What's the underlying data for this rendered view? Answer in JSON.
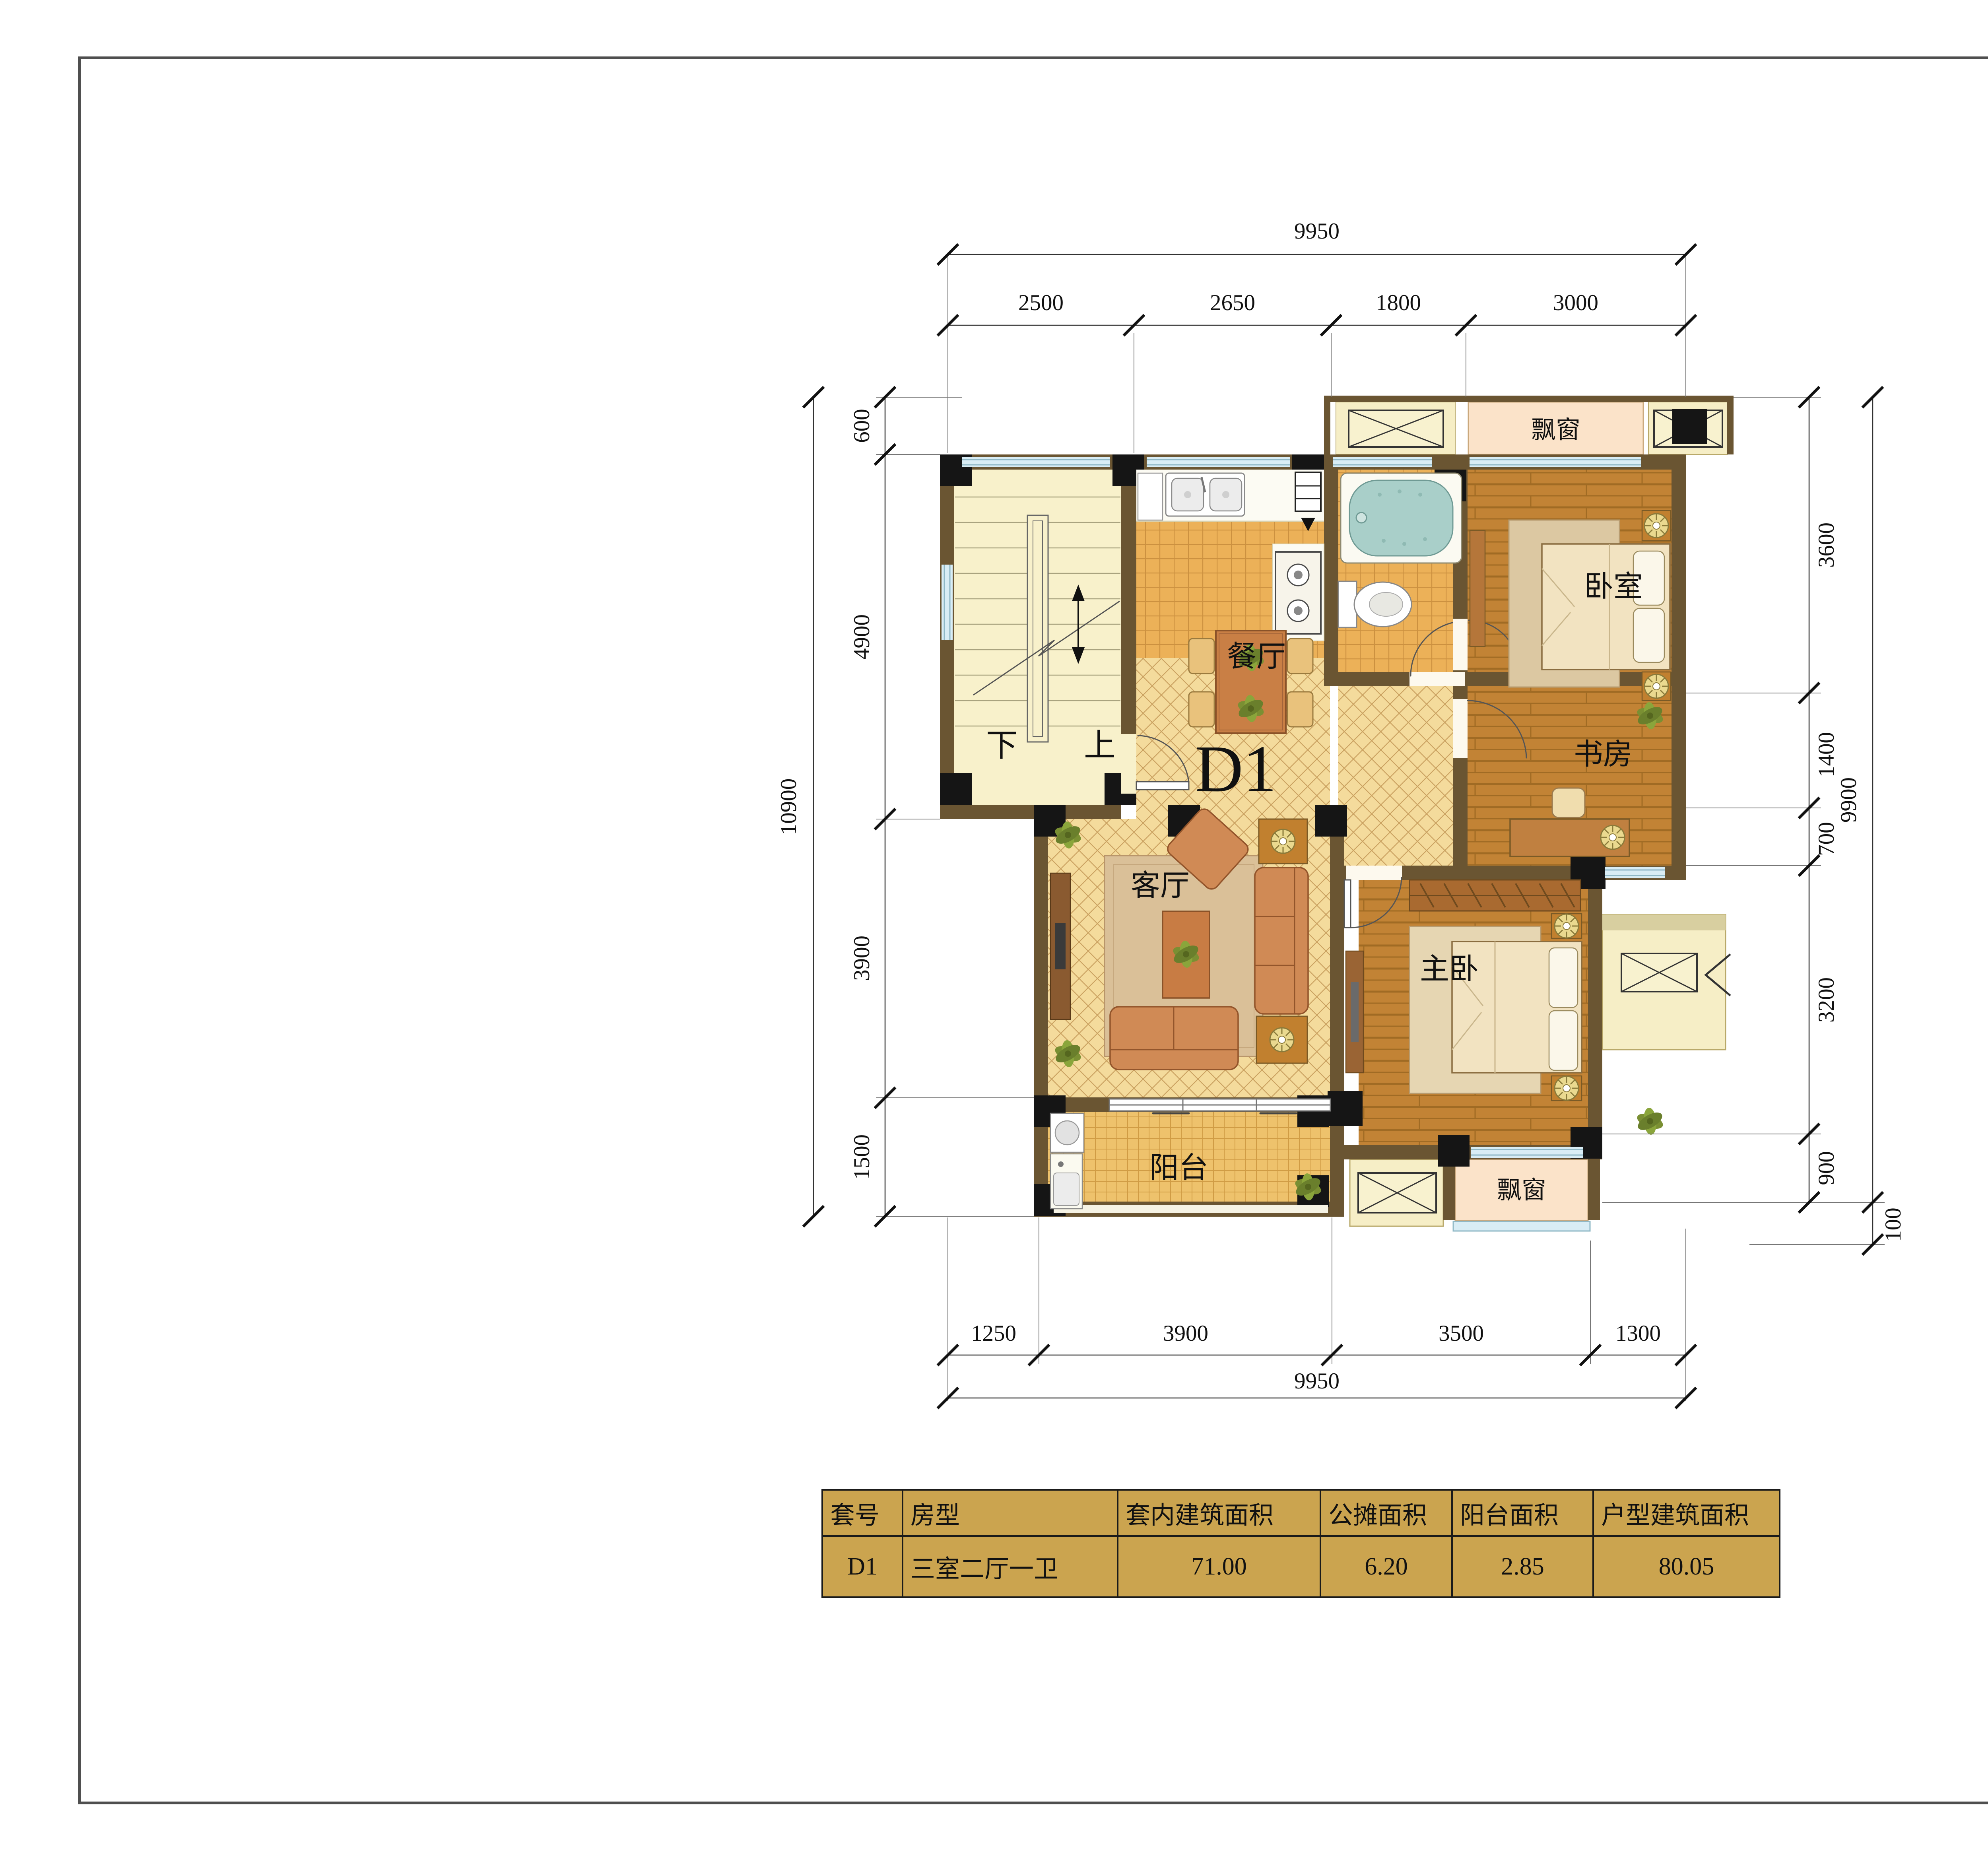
{
  "plan": {
    "unit_label": "D1",
    "rooms": {
      "dining": "餐厅",
      "living": "客厅",
      "bedroom": "卧室",
      "study": "书房",
      "master": "主卧",
      "balcony": "阳台",
      "bay_window_top": "飘窗",
      "bay_window_bottom": "飘窗"
    },
    "stair": {
      "down": "下",
      "up": "上"
    },
    "dims": {
      "top_total": "9950",
      "top_segments": [
        "2500",
        "2650",
        "1800",
        "3000"
      ],
      "bottom_segments": [
        "1250",
        "3900",
        "3500",
        "1300"
      ],
      "bottom_total": "9950",
      "left_total": "10900",
      "left_segments": [
        "600",
        "4900",
        "3900",
        "1500"
      ],
      "right_total": "9900",
      "right_segments": [
        "3600",
        "1400",
        "700",
        "3200",
        "900"
      ],
      "right_offset": "100"
    }
  },
  "table": {
    "headers": [
      "套号",
      "房型",
      "套内建筑面积",
      "公摊面积",
      "阳台面积",
      "户型建筑面积"
    ],
    "row": [
      "D1",
      "三室二厅一卫",
      "71.00",
      "6.20",
      "2.85",
      "80.05"
    ],
    "bg": "#cba44f"
  },
  "colors": {
    "wall": "#6a5532",
    "column": "#151515",
    "stair_floor": "#f8f1cb",
    "diamond_tile": "#f4db9c",
    "wood_floor": "#c28335",
    "kitchen_tile": "#ecb158",
    "balcony_tile": "#eec26c",
    "bay_window": "#fbe3c9",
    "ac_platform": "#f6eec6",
    "window_glass": "#d9edf5",
    "table_gold": "#cba44f"
  }
}
